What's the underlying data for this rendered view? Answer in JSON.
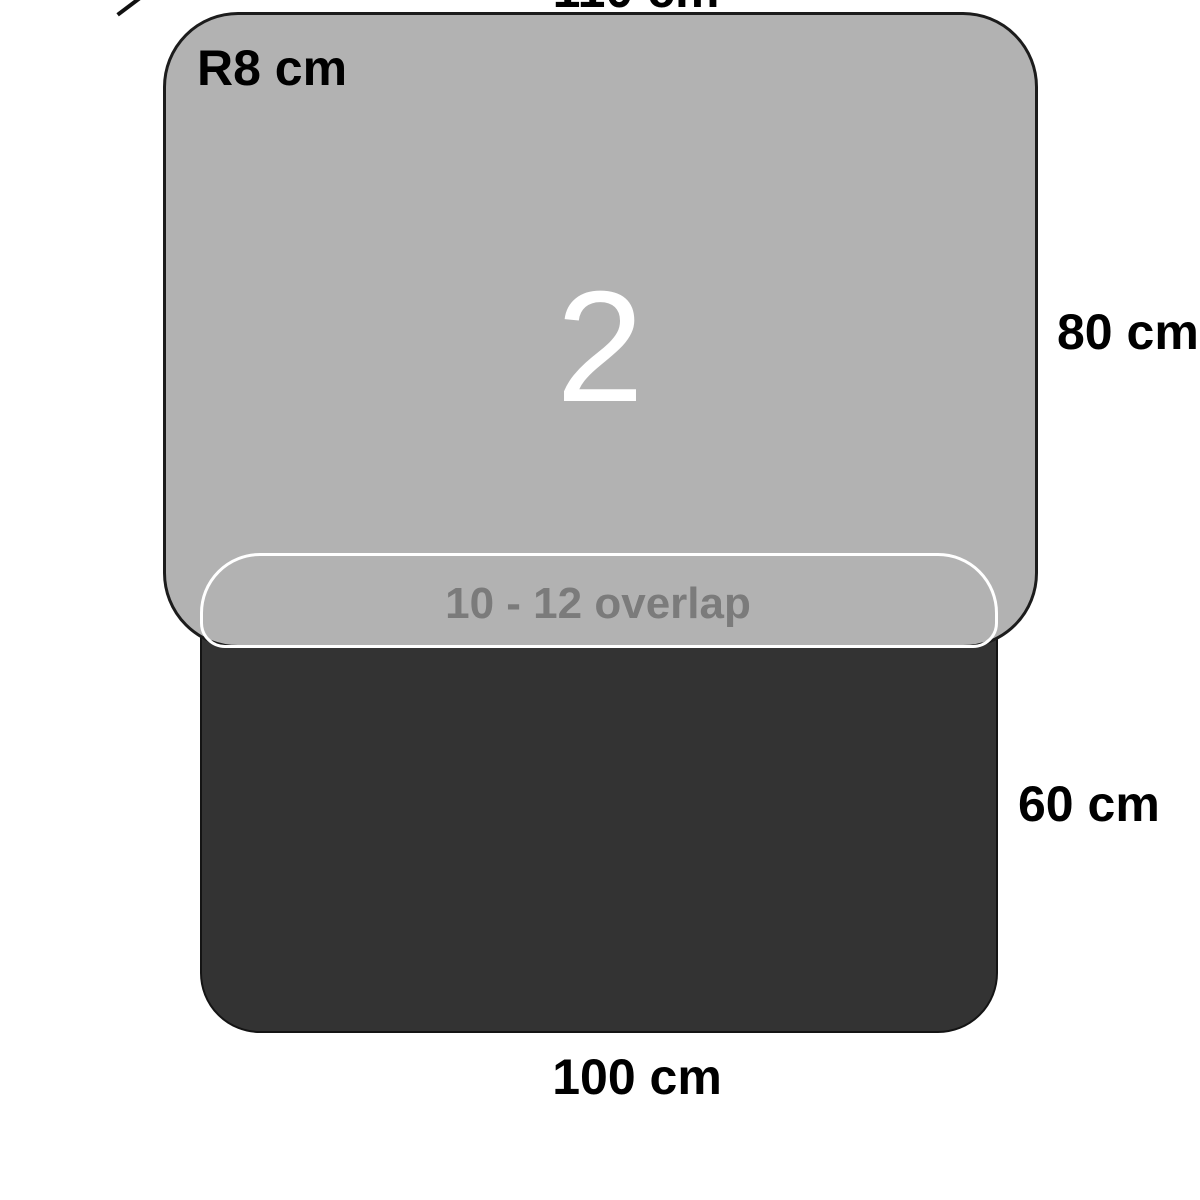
{
  "diagram": {
    "description": "Two overlapping mat pieces with dimensions",
    "upper_mat": {
      "number": "2",
      "width_label": "110 cm",
      "height_label": "80 cm",
      "corner_radius_label": "R8 cm",
      "fill": "#b2b2b2",
      "stroke": "#1c1c1c"
    },
    "lower_mat": {
      "width_label": "100 cm",
      "height_label": "60 cm",
      "fill": "#333333",
      "stroke": "#141414"
    },
    "overlap": {
      "label": "10 - 12 overlap",
      "outline_color": "#ffffff",
      "text_color": "#7b7b7b"
    }
  }
}
